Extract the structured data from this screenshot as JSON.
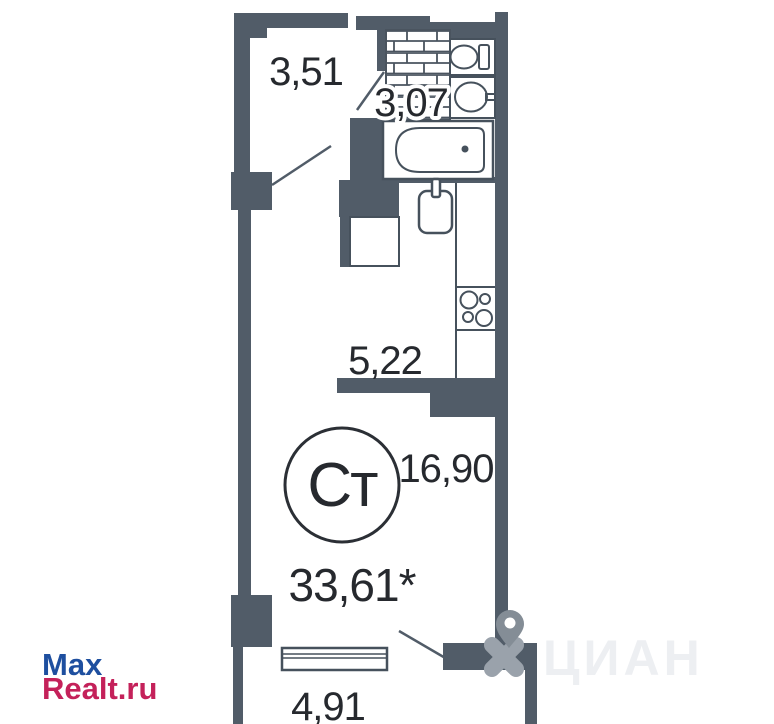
{
  "floorplan": {
    "type_badge": "Ст",
    "total_area_label": "33,61*",
    "rooms": {
      "hallway": "3,51",
      "bathroom": "3,07",
      "kitchen": "5,22",
      "living": "16,90",
      "balcony": "4,91"
    }
  },
  "watermarks": {
    "maxrealt": {
      "line1": "Max",
      "line2": "Realt.ru"
    },
    "cian": {
      "text": "ЦИАН"
    }
  },
  "colors": {
    "wall": "#515c68",
    "line": "#46515c",
    "text": "#26292e",
    "maxrealt-blue": "#1e4f9f",
    "maxrealt-red": "#c4215a",
    "cian-gray": "#9aa2ab",
    "cian-pin": "#848d96",
    "cian-text": "#edeff2",
    "background": "#ffffff"
  }
}
